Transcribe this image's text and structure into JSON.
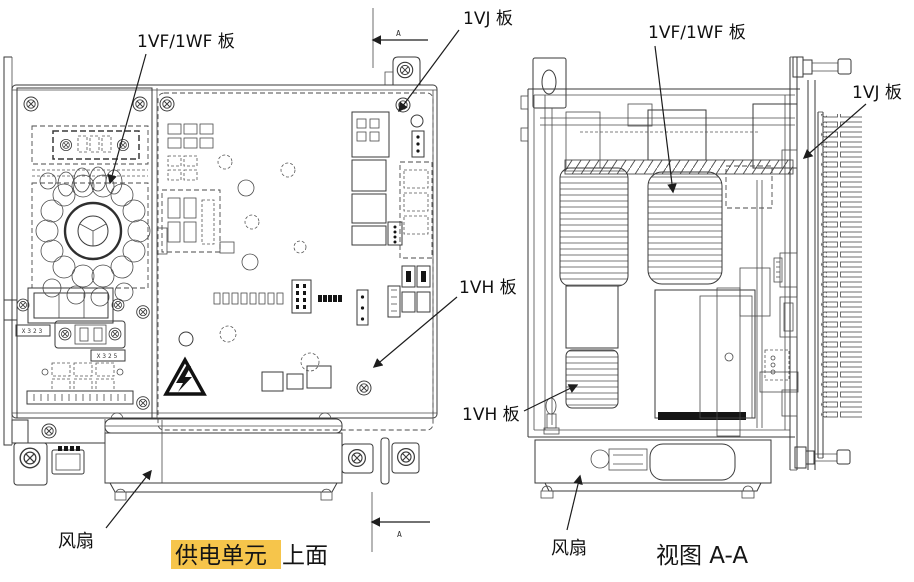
{
  "colors": {
    "line": "#3a3a3a",
    "background": "#ffffff",
    "highlight": "#f6c54b",
    "highlight_text": "#7a241a",
    "label_text": "#101010"
  },
  "left_view": {
    "labels": {
      "board_vf": "1VF/1WF 板",
      "board_vj": "1VJ 板",
      "board_vh": "1VH 板",
      "fan": "风扇"
    },
    "connectors": {
      "x323": "X323",
      "x325": "X325"
    },
    "caption": {
      "highlighted": "供电单元",
      "rest": "上面"
    }
  },
  "right_view": {
    "labels": {
      "board_vf": "1VF/1WF 板",
      "board_vj": "1VJ 板",
      "board_vh": "1VH 板",
      "fan": "风扇"
    },
    "caption": "视图 A-A"
  },
  "dimension": {
    "letter": "A"
  }
}
